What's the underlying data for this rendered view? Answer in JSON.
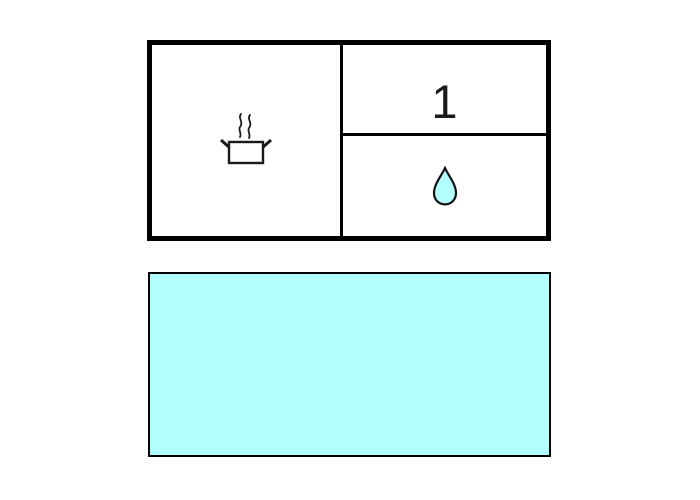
{
  "colors": {
    "background": "#ffffff",
    "line": "#000000",
    "water": "#b3feff"
  },
  "top_panel": {
    "heat_cell": {
      "icon": "steaming-pot-icon"
    },
    "count_cell": {
      "value": "1"
    },
    "drop_cell": {
      "icon": "water-drop-icon"
    }
  },
  "bottom_panel": {
    "icon": "water-body",
    "fill": "#b3feff"
  }
}
